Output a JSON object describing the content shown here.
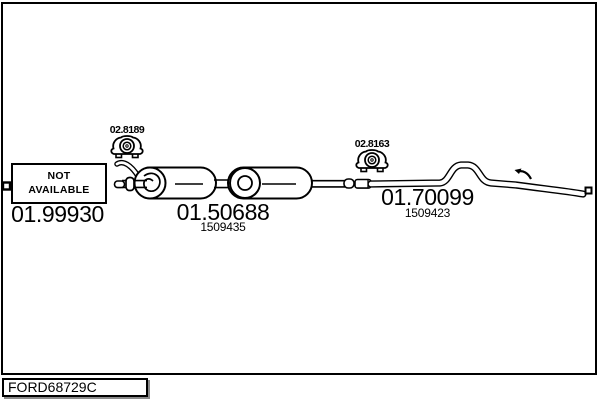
{
  "diagram": {
    "title_code": "FORD68729C",
    "colors": {
      "line": "#000000",
      "background": "#ffffff",
      "box_shadow": "#8a8a8a"
    },
    "parts": [
      {
        "code": "01.99930",
        "status_line1": "NOT",
        "status_line2": "AVAILABLE",
        "description": "front pipe - not available"
      },
      {
        "code": "01.50688",
        "ref": "1509435",
        "mount_code": "02.8189",
        "description": "centre silencer, two chambers"
      },
      {
        "code": "01.70099",
        "ref": "1509423",
        "mount_code": "02.8163",
        "description": "rear tail pipe with over-axle bend"
      }
    ]
  }
}
